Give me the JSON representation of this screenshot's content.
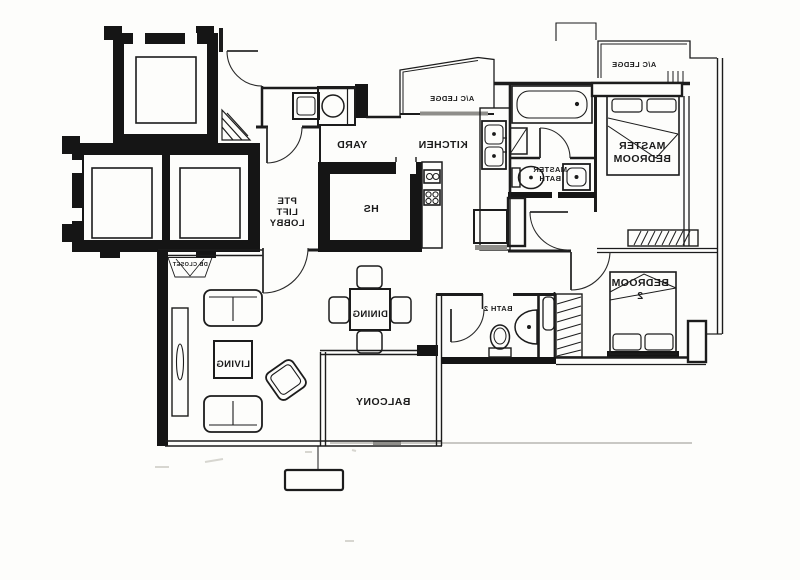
{
  "plan": {
    "rooms": {
      "master_bedroom": {
        "lines": [
          "MASTER",
          "BEDROOM"
        ]
      },
      "bedroom_2": {
        "lines": [
          "BEDROOM",
          "2"
        ]
      },
      "master_bath": {
        "lines": [
          "MASTER",
          "BATH"
        ]
      },
      "pte_lift_lobby": {
        "lines": [
          "PTE",
          "LIFT",
          "LOBBY"
        ]
      },
      "bath_2": {
        "label": "BATH 2"
      },
      "kitchen": {
        "label": "KITCHEN"
      },
      "yard": {
        "label": "YARD"
      },
      "hs": {
        "label": "HS"
      },
      "dining": {
        "label": "DINING"
      },
      "living": {
        "label": "LIVING"
      },
      "balcony": {
        "label": "BALCONY"
      },
      "db_closet": {
        "label": "DB CLOSET"
      },
      "ac_ledge_kitchen": {
        "label": "A/C LEDGE"
      },
      "ac_ledge_master": {
        "label": "A/C LEDGE"
      }
    },
    "colors": {
      "ink": "#1c1c1c",
      "paper": "#fdfdfb",
      "muted": "#9a9a9a"
    }
  }
}
